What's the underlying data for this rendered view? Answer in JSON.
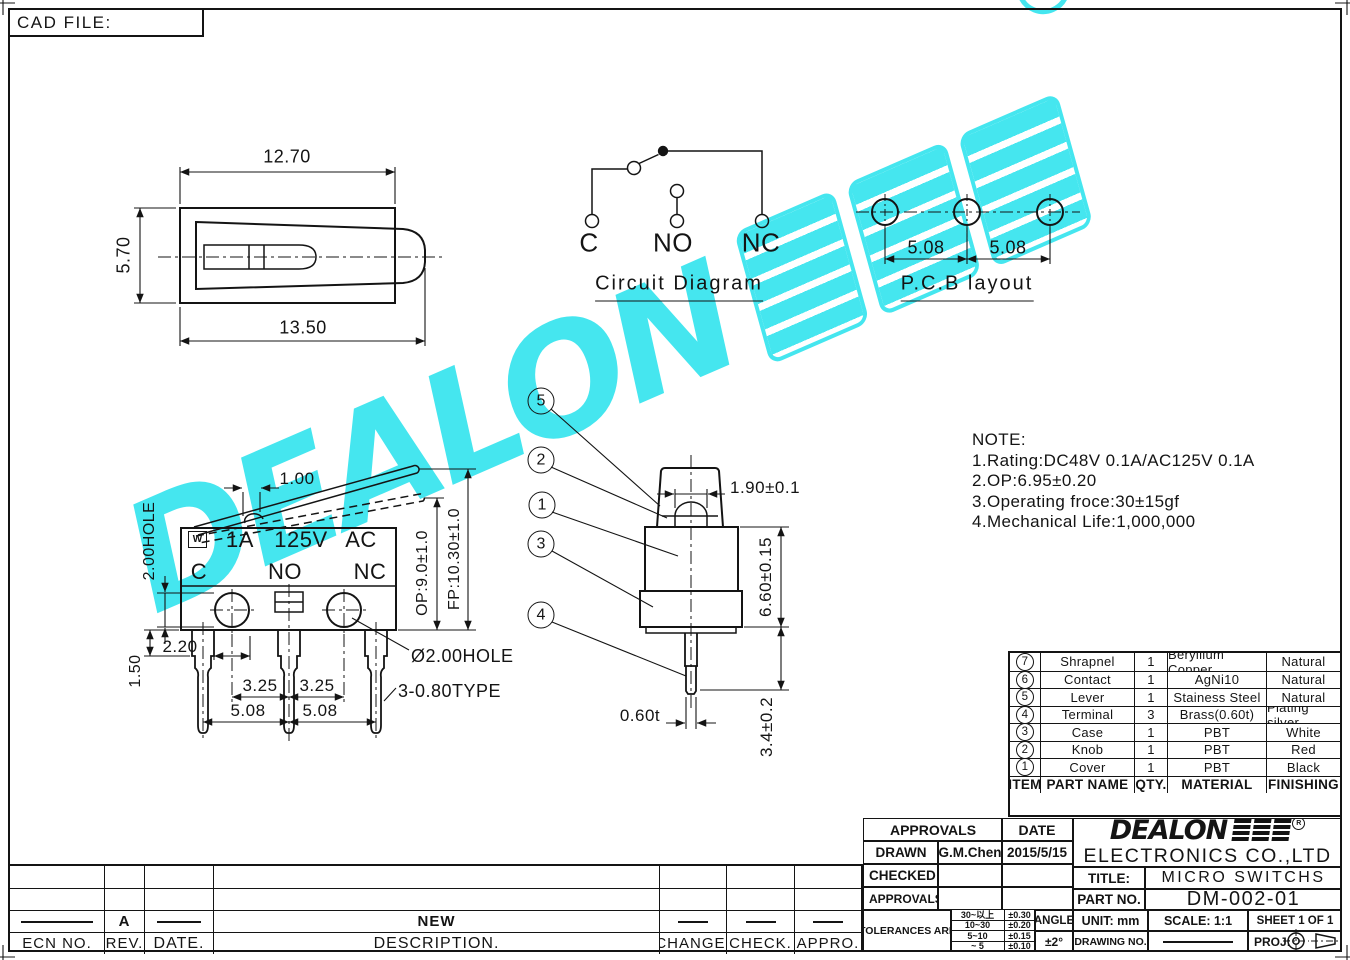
{
  "page": {
    "cad_file_label": "CAD FILE:"
  },
  "watermark": {
    "latin": "DEALON",
    "cjk": "德艺隆",
    "reg": "R",
    "color": "#45E6EF"
  },
  "top_view": {
    "width_top": "12.70",
    "width_total": "13.50",
    "height": "5.70"
  },
  "circuit": {
    "c": "C",
    "no": "NO",
    "nc": "NC",
    "title": "Circuit Diagram"
  },
  "pcb": {
    "pitch_a": "5.08",
    "pitch_b": "5.08",
    "title": "P.C.B layout"
  },
  "note": {
    "heading": "NOTE:",
    "line1": "1.Rating:DC48V 0.1A/AC125V 0.1A",
    "line2": "2.OP:6.95±0.20",
    "line3": "3.Operating froce:30±15gf",
    "line4": "4.Mechanical Life:1,000,000"
  },
  "front_view": {
    "cert_mark": "W",
    "current": "1A",
    "voltage": "125V",
    "ac": "AC",
    "t_c": "C",
    "t_no": "NO",
    "t_nc": "NC",
    "dim_lever": "1.00",
    "dim_hole": "2.00HOLE",
    "dim_2_20": "2.20",
    "dim_1_50": "1.50",
    "dim_3_25a": "3.25",
    "dim_3_25b": "3.25",
    "dim_5_08a": "5.08",
    "dim_5_08b": "5.08",
    "dim_op": "OP:9.0±1.0",
    "dim_fp": "FP:10.30±1.0",
    "dim_hole_dia": "Ø2.00HOLE",
    "dim_pin_type": "3-0.80TYPE"
  },
  "side_view": {
    "callouts": [
      "5",
      "2",
      "1",
      "3",
      "4"
    ],
    "dim_knob": "1.90±0.1",
    "dim_height": "6.60±0.15",
    "dim_pin_len": "3.4±0.2",
    "dim_pin_thk": "0.60t"
  },
  "parts_table": {
    "headers": {
      "item": "ITEM",
      "part": "PART NAME",
      "qty": "QTY.",
      "material": "MATERIAL",
      "finishing": "FINISHING"
    },
    "rows": [
      {
        "item": "7",
        "part": "Shrapnel",
        "qty": "1",
        "material": "Beryllium Copper",
        "finishing": "Natural"
      },
      {
        "item": "6",
        "part": "Contact",
        "qty": "1",
        "material": "AgNi10",
        "finishing": "Natural"
      },
      {
        "item": "5",
        "part": "Lever",
        "qty": "1",
        "material": "Stainess Steel",
        "finishing": "Natural"
      },
      {
        "item": "4",
        "part": "Terminal",
        "qty": "3",
        "material": "Brass(0.60t)",
        "finishing": "Plating silver"
      },
      {
        "item": "3",
        "part": "Case",
        "qty": "1",
        "material": "PBT",
        "finishing": "White"
      },
      {
        "item": "2",
        "part": "Knob",
        "qty": "1",
        "material": "PBT",
        "finishing": "Red"
      },
      {
        "item": "1",
        "part": "Cover",
        "qty": "1",
        "material": "PBT",
        "finishing": "Black"
      }
    ]
  },
  "title_block": {
    "approvals": "APPROVALS",
    "date": "DATE",
    "drawn": "DRAWN",
    "drawn_name": "G.M.Chen",
    "drawn_date": "2015/5/15",
    "checked": "CHECKED",
    "approvals2": "APPROVALS",
    "tolerances": "TOLERANCES ARE",
    "tol": [
      {
        "range": "30~以上",
        "value": "±0.30"
      },
      {
        "range": "10~30",
        "value": "±0.20"
      },
      {
        "range": "5~10",
        "value": "±0.15"
      },
      {
        "range": "~ 5",
        "value": "±0.10"
      }
    ],
    "angle": "ANGLE",
    "angle_value": "±2°",
    "company": "ELECTRONICS CO.,LTD",
    "title_label": "TITLE:",
    "title": "MICRO SWITCHS",
    "part_no_label": "PART NO.",
    "part_no": "DM-002-01",
    "unit": "UNIT: mm",
    "scale": "SCALE: 1:1",
    "sheet": "SHEET 1 OF 1",
    "drawing_no": "DRAWING NO.",
    "proj": "PROJ:"
  },
  "revision_table": {
    "rev": "A",
    "description": "NEW",
    "ecn_label": "ECN NO.",
    "rev_label": "REV.",
    "date_label": "DATE.",
    "desc_label": "DESCRIPTION.",
    "change_label": "CHANGE.",
    "check_label": "CHECK.",
    "appro_label": "APPRO."
  }
}
